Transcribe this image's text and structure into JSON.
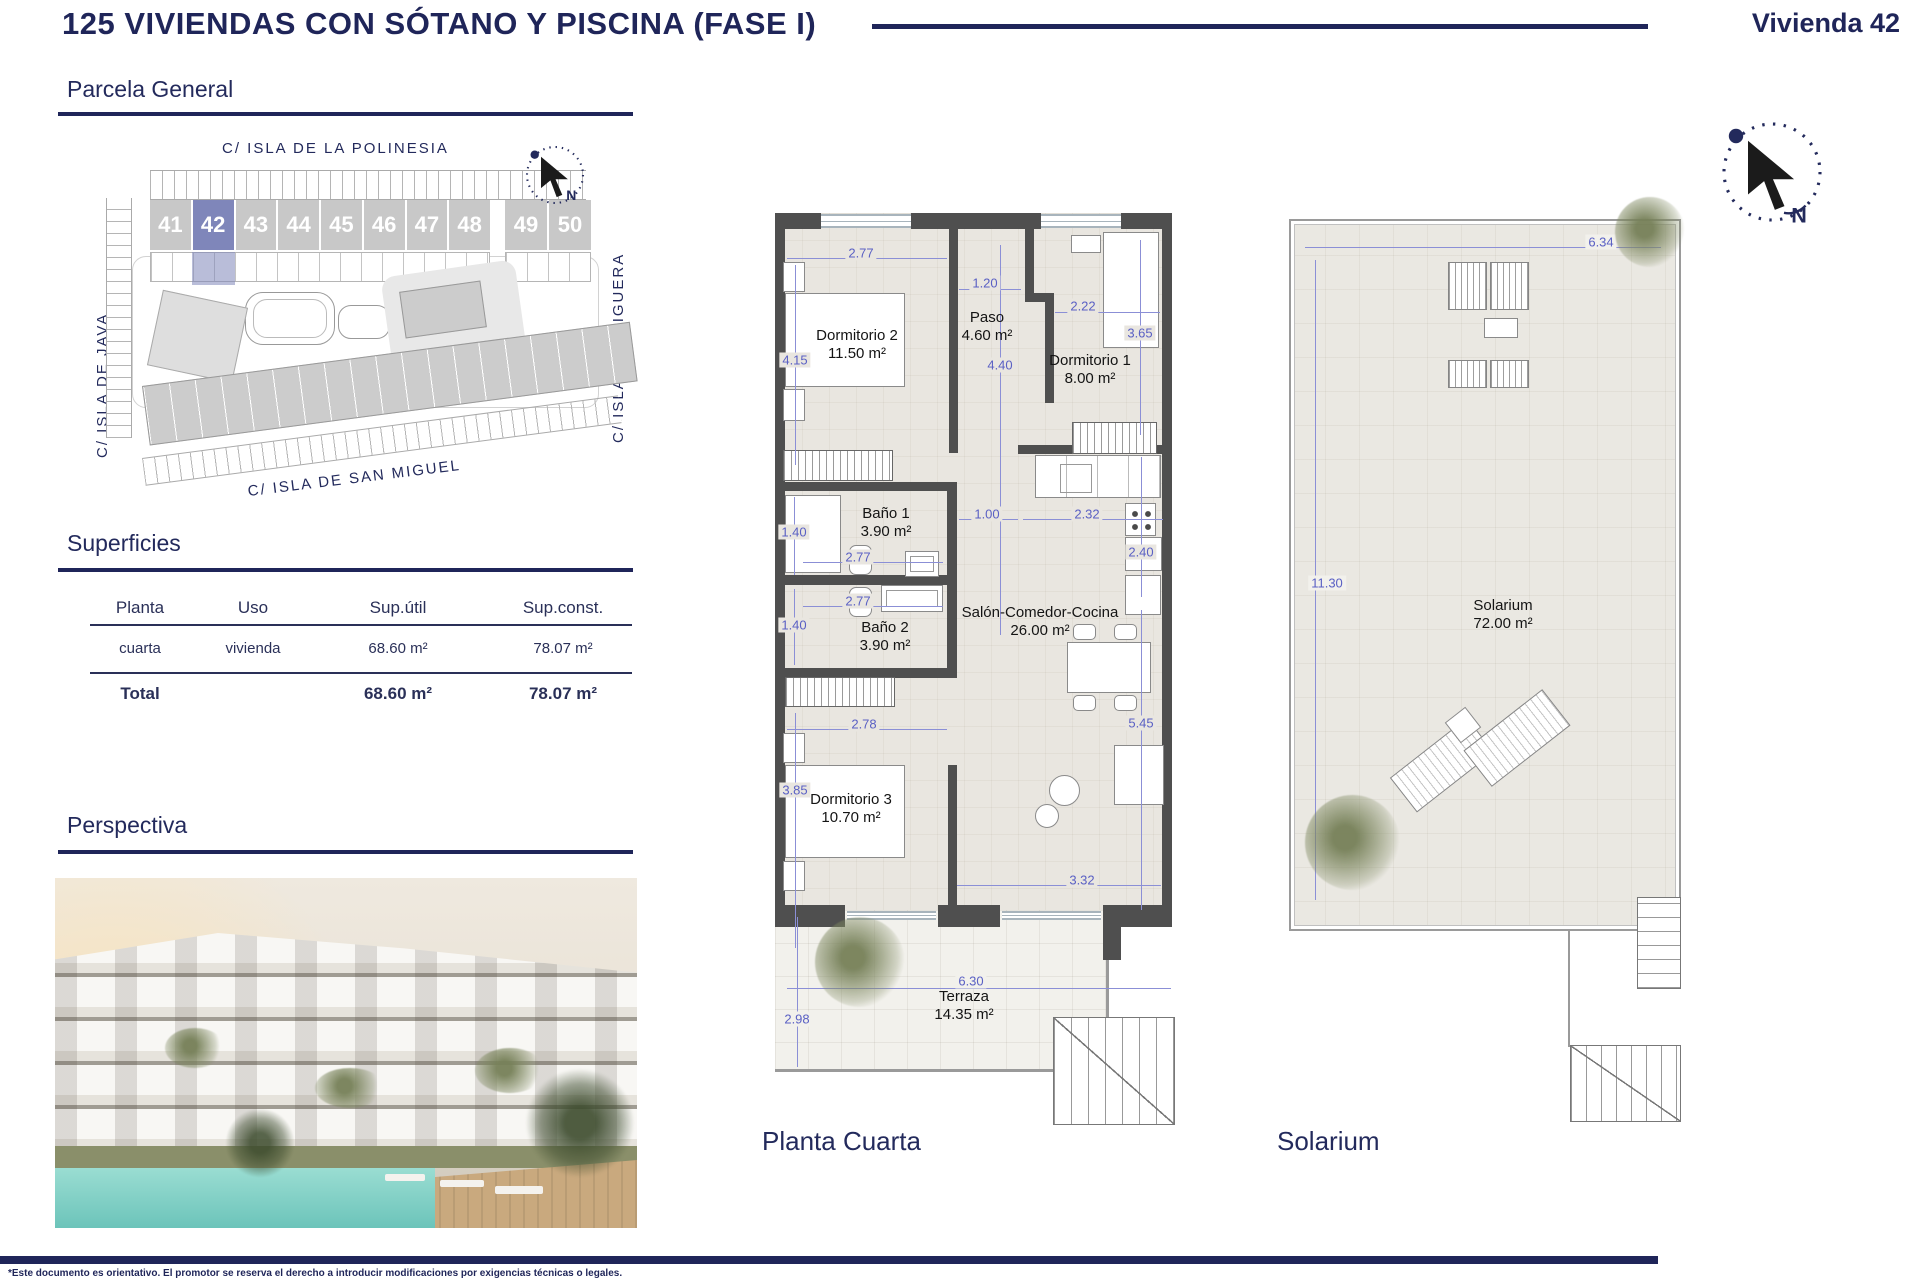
{
  "header": {
    "title": "125 VIVIENDAS CON SÓTANO Y PISCINA (FASE I)",
    "unit": "Vivienda 42"
  },
  "sections": {
    "parcela": "Parcela General",
    "superficies": "Superficies",
    "perspectiva": "Perspectiva"
  },
  "site_plan": {
    "streets": {
      "top": "C/ ISLA DE LA POLINESIA",
      "left": "C/ ISLA DE JAVA",
      "right": "C/ ISLA PERDIGUERA",
      "bottom": "C/ ISLA DE SAN MIGUEL"
    },
    "units": [
      "41",
      "42",
      "43",
      "44",
      "45",
      "46",
      "47",
      "48",
      "49",
      "50"
    ],
    "highlighted_unit": "42"
  },
  "superficies_table": {
    "headers": [
      "Planta",
      "Uso",
      "Sup.útil",
      "Sup.const."
    ],
    "row": {
      "planta": "cuarta",
      "uso": "vivienda",
      "sup_util": "68.60 m²",
      "sup_const": "78.07 m²"
    },
    "total": {
      "label": "Total",
      "sup_util": "68.60 m²",
      "sup_const": "78.07 m²"
    }
  },
  "floor_plan": {
    "caption": "Planta Cuarta",
    "rooms": [
      {
        "name": "Dormitorio 2",
        "area": "11.50 m²"
      },
      {
        "name": "Paso",
        "area": "4.60 m²"
      },
      {
        "name": "Dormitorio 1",
        "area": "8.00 m²"
      },
      {
        "name": "Baño 1",
        "area": "3.90 m²"
      },
      {
        "name": "Baño 2",
        "area": "3.90 m²"
      },
      {
        "name": "Salón-Comedor-Cocina",
        "area": "26.00 m²"
      },
      {
        "name": "Dormitorio 3",
        "area": "10.70 m²"
      },
      {
        "name": "Terraza",
        "area": "14.35 m²"
      }
    ],
    "dimensions": {
      "dorm2_w": "2.77",
      "dorm2_h": "4.15",
      "paso_w": "1.20",
      "paso_h": "4.40",
      "dorm1_w": "2.22",
      "dorm1_h": "3.65",
      "bano1_h": "1.40",
      "bano1_w": "2.77",
      "bano2_w": "2.77",
      "bano2_h": "1.40",
      "pass_w": "1.00",
      "cocina_w": "2.32",
      "cocina_h": "2.40",
      "dorm3_w": "2.78",
      "salon_h": "5.45",
      "dorm3_h": "3.85",
      "salon_w": "3.32",
      "terraza_w": "6.30",
      "terraza_h": "2.98"
    }
  },
  "solarium_plan": {
    "caption": "Solarium",
    "room": {
      "name": "Solarium",
      "area": "72.00 m²"
    },
    "dimensions": {
      "width": "6.34",
      "height": "11.30"
    }
  },
  "compass": {
    "north_label": "N"
  },
  "footer": {
    "disclaimer": "*Este documento es orientativo. El promotor se reserva el derecho a introducir modificaciones por exigencias técnicas o legales."
  },
  "colors": {
    "navy": "#1f2559",
    "dim_blue": "#5a60c4",
    "wall_gray": "#4f4f4f",
    "highlight_unit": "#7f86ba",
    "floor": "#e9e6e0",
    "pool": "#7fd0c4"
  }
}
